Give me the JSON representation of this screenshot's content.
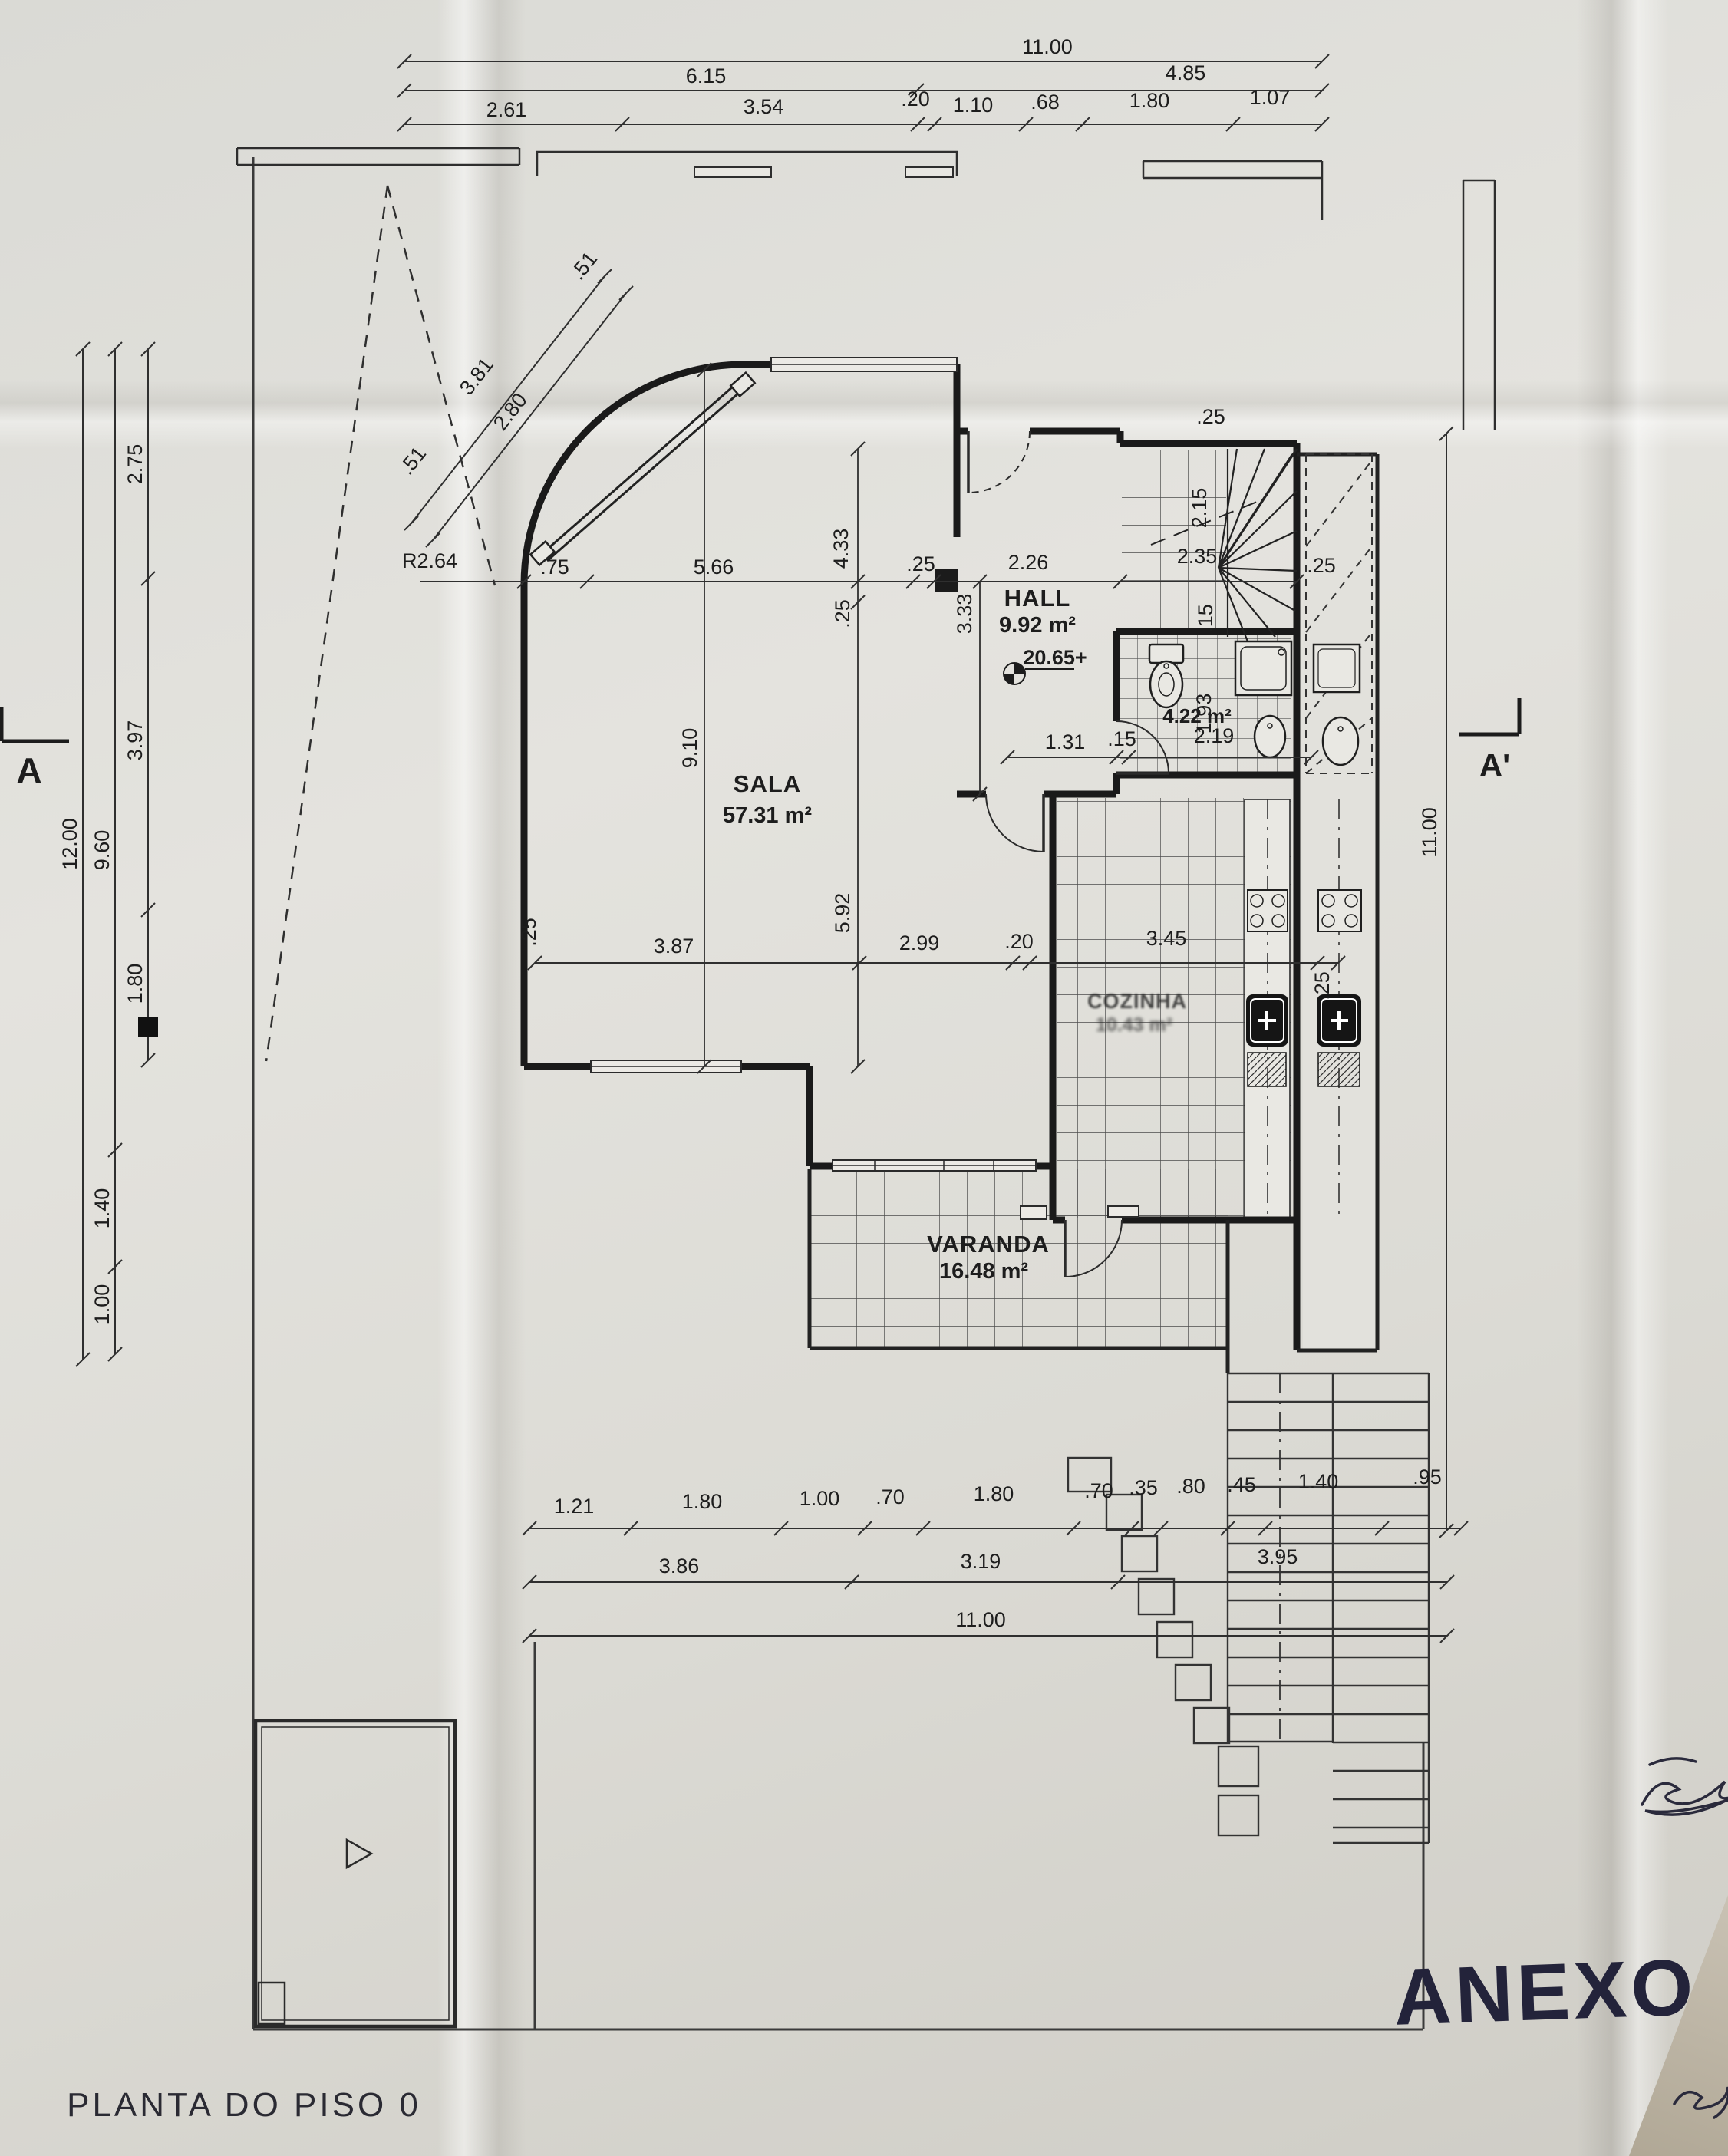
{
  "drawing": {
    "title": "PLANTA DO PISO 0",
    "handwritten_note": "ANEXO",
    "section_marker_left": "A",
    "section_marker_right": "A'",
    "level_mark": "20.65+",
    "radius_label": "R2.64"
  },
  "rooms": {
    "hall": {
      "name": "HALL",
      "area": "9.92 m²"
    },
    "sala": {
      "name": "SALA",
      "area": "57.31 m²"
    },
    "cozinha": {
      "name": "COZINHA",
      "area": "10.43 m²"
    },
    "varanda": {
      "name": "VARANDA",
      "area": "16.48 m²"
    },
    "banho": {
      "area": "4.22 m²"
    }
  },
  "dims": {
    "top_total": "11.00",
    "top_row2": [
      "6.15",
      "4.85"
    ],
    "top_row3": [
      "2.61",
      "3.54",
      ".20",
      "1.10",
      ".68",
      "1.80",
      "1.07"
    ],
    "left_total": "12.00",
    "left_mid": "9.60",
    "left_sub": [
      "2.75",
      "3.97",
      "1.80",
      "1.40",
      "1.00"
    ],
    "right_total": "11.00",
    "bottom_row1": [
      "1.21",
      "1.80",
      "1.00",
      ".70",
      "1.80",
      ".70",
      ".35",
      ".80",
      ".45",
      "1.40",
      ".95"
    ],
    "bottom_row2": [
      "3.86",
      "3.19",
      "3.95"
    ],
    "bottom_total": "11.00",
    "sala_width": "5.66",
    "curve_offset": ".75",
    "wall_left_thk": ".25",
    "hall_wall_thk": ".25",
    "hall_width": "2.26",
    "v_433": "4.33",
    "v_333": "3.33",
    "v_910": "9.10",
    "v_25": ".25",
    "v_592": "5.92",
    "mid_row": [
      "3.87",
      "2.99",
      ".20",
      "3.45"
    ],
    "mid_right_thk": ".25",
    "wc_row": [
      "1.31",
      ".15",
      "2.19"
    ],
    "wc_depth": "1.93",
    "wall_15": ".15",
    "stair_w1": "2.15",
    "stair_w2": "2.35",
    "stair_thk_top": ".25",
    "stair_thk_right": ".25",
    "diag": [
      "3.81",
      "2.80",
      ".51",
      ".51"
    ]
  }
}
